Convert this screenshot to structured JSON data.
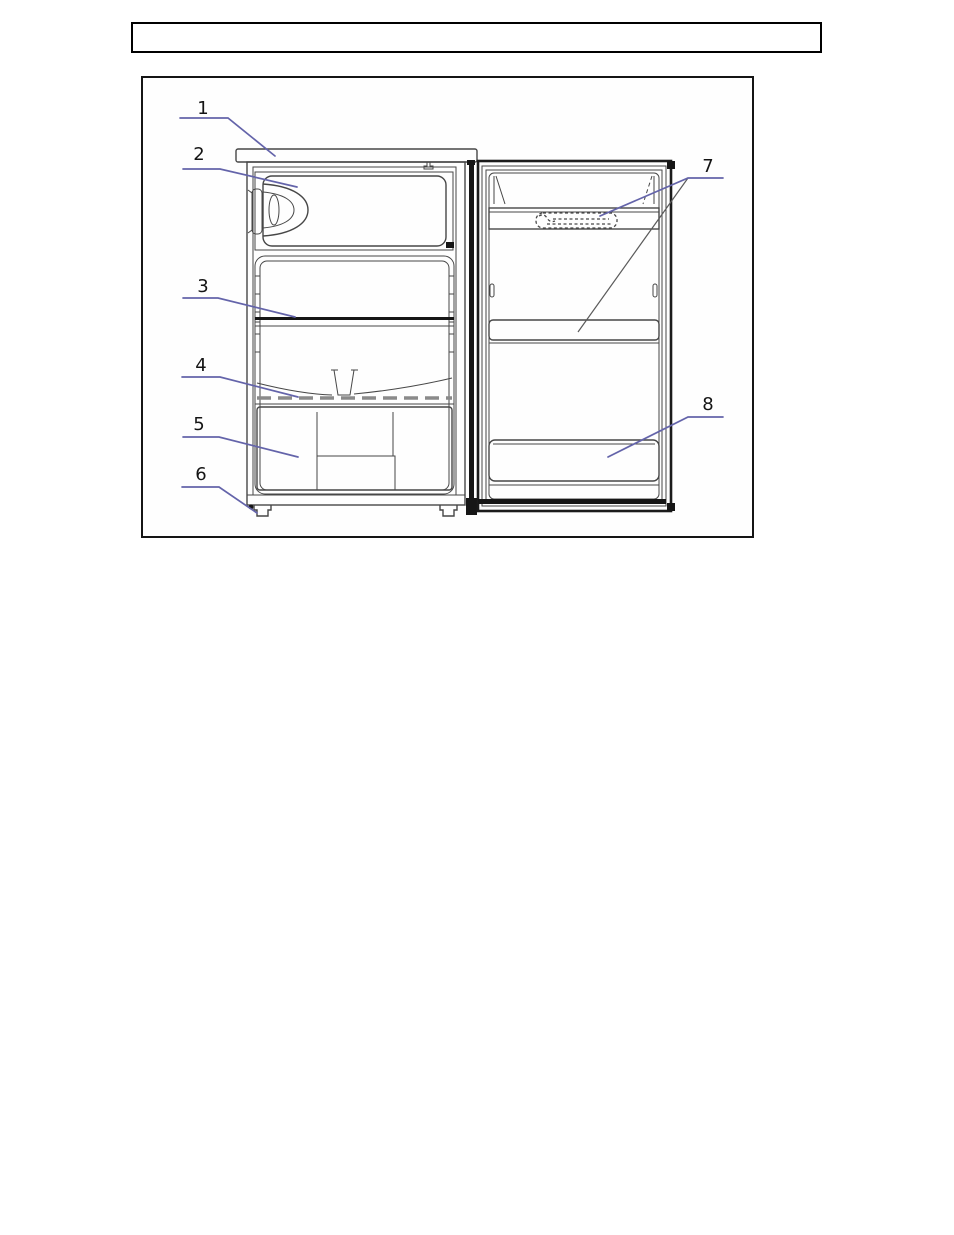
{
  "header_box": {
    "text": ""
  },
  "diagram": {
    "kind": "refrigerator-parts-diagram",
    "callout_color": "#6464aa",
    "outline_color": "#474747",
    "frame_color": "#151515",
    "labels": [
      {
        "text": "1",
        "part": "worktop"
      },
      {
        "text": "2",
        "part": "freezer-compartment-door"
      },
      {
        "text": "3",
        "part": "shelf"
      },
      {
        "text": "4",
        "part": "crisper-cover"
      },
      {
        "text": "5",
        "part": "crisper-drawer"
      },
      {
        "text": "6",
        "part": "levelling-foot"
      },
      {
        "text": "7",
        "part": "upper-door-balcony"
      },
      {
        "text": "8",
        "part": "lower-door-balcony"
      }
    ]
  }
}
